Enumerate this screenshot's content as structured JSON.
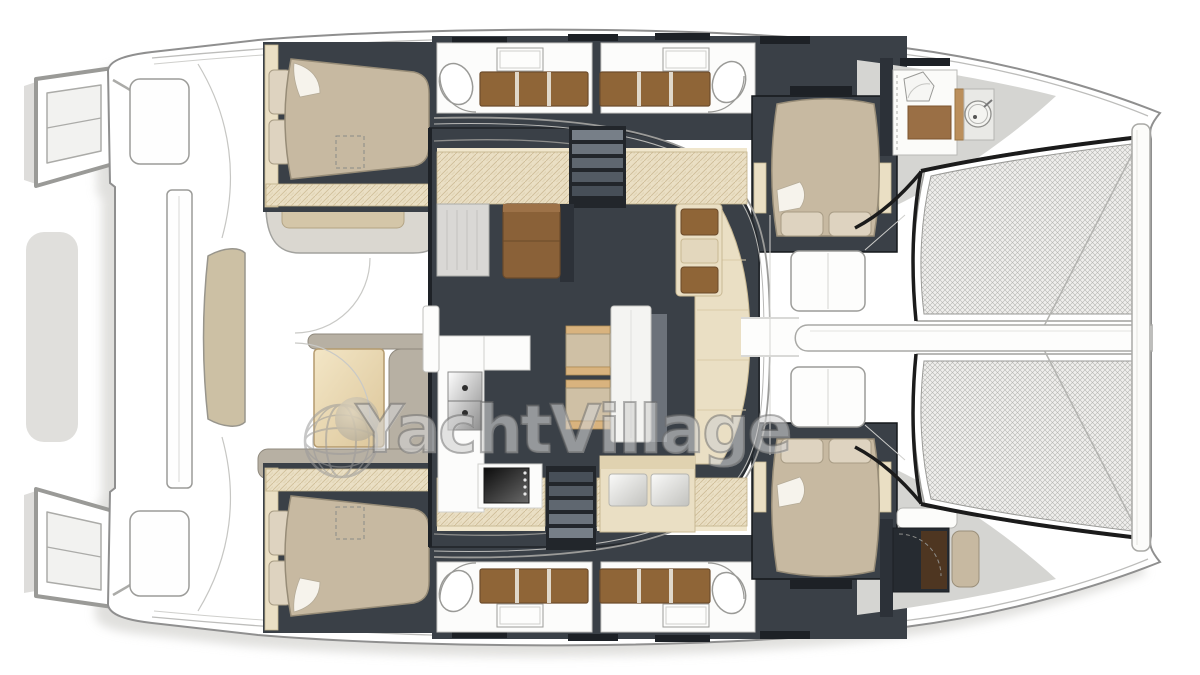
{
  "watermark": {
    "text": "YachtVillage",
    "icon": "globe-icon"
  },
  "plan": {
    "type": "catamaran-interior-floor-plan",
    "areas": [
      "stern-platforms",
      "aft-cockpit",
      "port-hull-cabins",
      "starboard-hull-cabins",
      "salon",
      "galley",
      "dinette",
      "bow-cabins",
      "bow-bathroom",
      "foredeck",
      "trampoline"
    ]
  },
  "colors": {
    "charcoal": "#3a4047",
    "charcoalDark": "#2c3138",
    "wheat": "#eadfc4",
    "wheatLine": "#c9b78f",
    "wood": "#d9b37e",
    "brown": "#8f6537",
    "brownDark": "#6b4a2a",
    "bedTan": "#c7b9a1",
    "bedTanLight": "#ded3c0",
    "sofaGray": "#b7b0a3",
    "deckGray": "#d5d5d2",
    "hullStroke": "#8f8f8f",
    "blackLine": "#1b1b1b",
    "watermark": "#9a9a9a"
  }
}
